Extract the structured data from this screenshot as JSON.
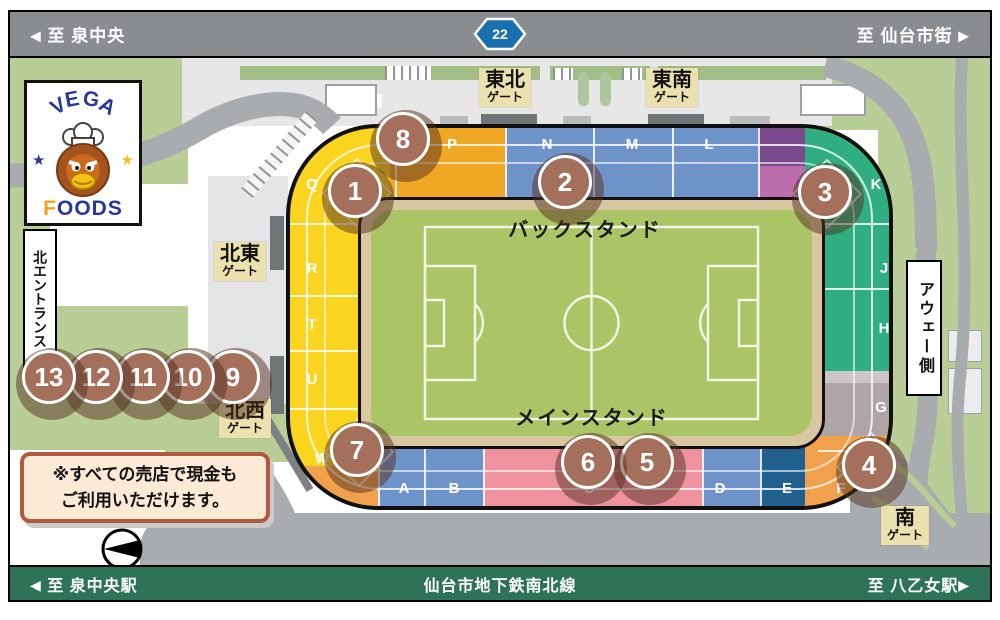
{
  "top_bar": {
    "left_label": "至 泉中央",
    "right_label": "至 仙台市街",
    "route_sign": "22"
  },
  "bottom_bar": {
    "left_label": "至 泉中央駅",
    "center_label": "仙台市地下鉄南北線",
    "right_label": "至 八乙女駅"
  },
  "logo": {
    "line1": "VEGA",
    "line2": "FOODS"
  },
  "stands": {
    "back": "バックスタンド",
    "main": "メインスタンド"
  },
  "side_labels": {
    "north_entrance": "北エントランス",
    "away_side": "アウェー側"
  },
  "notice": {
    "line1": "※すべての売店で現金も",
    "line2": "ご利用いただけます。"
  },
  "gates": [
    {
      "name": "東北",
      "suffix": "ゲート",
      "x": 495,
      "y": 10
    },
    {
      "name": "東南",
      "suffix": "ゲート",
      "x": 662,
      "y": 10
    },
    {
      "name": "北東",
      "suffix": "ゲート",
      "x": 230,
      "y": 184
    },
    {
      "name": "北西",
      "suffix": "ゲート",
      "x": 235,
      "y": 341
    },
    {
      "name": "南",
      "suffix": "ゲート",
      "x": 895,
      "y": 448
    }
  ],
  "sections": [
    {
      "letter": "Q",
      "x": 12,
      "y": 48
    },
    {
      "letter": "R",
      "x": 12,
      "y": 132
    },
    {
      "letter": "T",
      "x": 12,
      "y": 188
    },
    {
      "letter": "U",
      "x": 12,
      "y": 243
    },
    {
      "letter": "W",
      "x": 22,
      "y": 322
    },
    {
      "letter": "P",
      "x": 152,
      "y": 8
    },
    {
      "letter": "N",
      "x": 247,
      "y": 8
    },
    {
      "letter": "M",
      "x": 332,
      "y": 8
    },
    {
      "letter": "L",
      "x": 409,
      "y": 8
    },
    {
      "letter": "K",
      "x": 576,
      "y": 48
    },
    {
      "letter": "J",
      "x": 584,
      "y": 132
    },
    {
      "letter": "H",
      "x": 584,
      "y": 192
    },
    {
      "letter": "G",
      "x": 581,
      "y": 271
    },
    {
      "letter": "F",
      "x": 541,
      "y": 352
    },
    {
      "letter": "A",
      "x": 104,
      "y": 352
    },
    {
      "letter": "B",
      "x": 154,
      "y": 352
    },
    {
      "letter": "C",
      "x": 289,
      "y": 352
    },
    {
      "letter": "D",
      "x": 420,
      "y": 352
    },
    {
      "letter": "E",
      "x": 487,
      "y": 352
    }
  ],
  "stalls": [
    {
      "n": "1",
      "x": 345,
      "y": 133
    },
    {
      "n": "2",
      "x": 555,
      "y": 124
    },
    {
      "n": "3",
      "x": 815,
      "y": 134
    },
    {
      "n": "4",
      "x": 859,
      "y": 407
    },
    {
      "n": "5",
      "x": 637,
      "y": 404
    },
    {
      "n": "6",
      "x": 578,
      "y": 404
    },
    {
      "n": "7",
      "x": 347,
      "y": 392
    },
    {
      "n": "8",
      "x": 393,
      "y": 81
    },
    {
      "n": "9",
      "x": 223,
      "y": 319
    },
    {
      "n": "10",
      "x": 178,
      "y": 319
    },
    {
      "n": "11",
      "x": 133,
      "y": 319
    },
    {
      "n": "12",
      "x": 86,
      "y": 319
    },
    {
      "n": "13",
      "x": 39,
      "y": 319
    }
  ],
  "colors": {
    "yellow": "#fbd41f",
    "amber": "#f0a724",
    "blue": "#6e93c8",
    "purple_dark": "#7b4a8e",
    "purple_light": "#bb6dad",
    "green_stand": "#2fae82",
    "gray_stand": "#b0a5a6",
    "gray_stand_light": "#cdc5c6",
    "orange": "#f1a04b",
    "pink": "#ee929e",
    "navy": "#20608e",
    "field": "#abc566",
    "ring_tan": "#d8c7a1",
    "marker": "#a4705c",
    "marker_shadow": "rgba(84,48,29,0.5)",
    "bar_gray": "#898d90",
    "bar_green": "#2e7257",
    "route_blue": "#1a6fae",
    "gate_bg": "#eae1ae",
    "road": "#a9acaf",
    "grass": "#b9ce97",
    "plaza": "#e7e7e8",
    "hedge": "#a2bd85",
    "notice_bg": "#fcead6",
    "notice_border": "#b3593f"
  }
}
